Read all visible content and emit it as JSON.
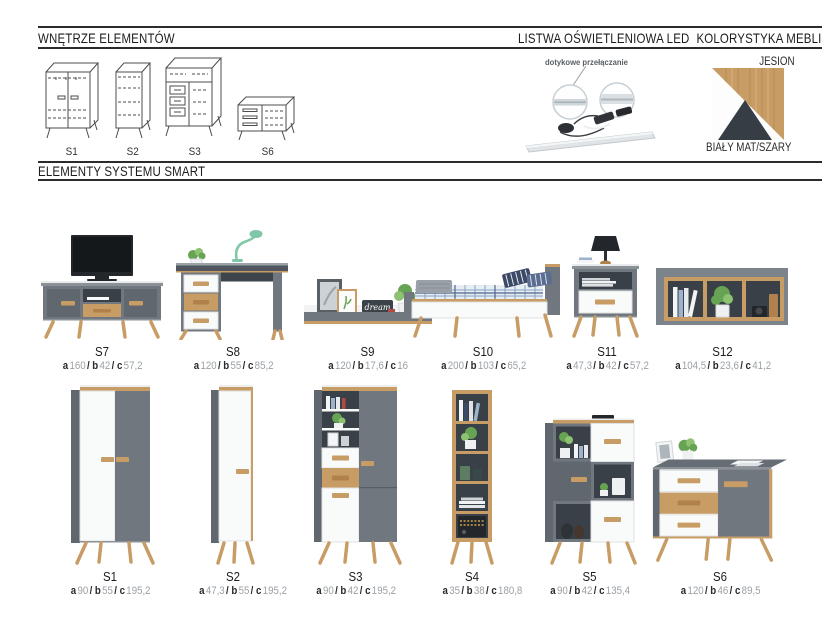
{
  "headers": {
    "interiors": "WNĘTRZE ELEMENTÓW",
    "led": "LISTWA OŚWIETLENIOWA LED",
    "colors": "KOLORYSTYKA MEBLI",
    "system": "ELEMENTY SYSTEMU SMART"
  },
  "led": {
    "caption": "dotykowe przełączanie"
  },
  "palette": {
    "label_top": "JESION",
    "label_bottom": "BIAŁY MAT/SZARY",
    "wood": "#c89c65",
    "graphite": "#363d44",
    "white": "#fdfdfd"
  },
  "interiors": [
    {
      "label": "S1"
    },
    {
      "label": "S2"
    },
    {
      "label": "S3"
    },
    {
      "label": "S6"
    }
  ],
  "dim_labels": {
    "a": "a",
    "b": "b",
    "c": "c",
    "sep": "/"
  },
  "row1": [
    {
      "name": "S7",
      "a": "160",
      "b": "42",
      "c": "57,2"
    },
    {
      "name": "S8",
      "a": "120",
      "b": "55",
      "c": "85,2"
    },
    {
      "name": "S9",
      "a": "120",
      "b": "17,6",
      "c": "16"
    },
    {
      "name": "S10",
      "a": "200",
      "b": "103",
      "c": "65,2"
    },
    {
      "name": "S11",
      "a": "47,3",
      "b": "42",
      "c": "57,2"
    },
    {
      "name": "S12",
      "a": "104,5",
      "b": "23,6",
      "c": "41,2"
    }
  ],
  "row2": [
    {
      "name": "S1",
      "a": "90",
      "b": "55",
      "c": "195,2"
    },
    {
      "name": "S2",
      "a": "47,3",
      "b": "55",
      "c": "195,2"
    },
    {
      "name": "S3",
      "a": "90",
      "b": "42",
      "c": "195,2"
    },
    {
      "name": "S4",
      "a": "35",
      "b": "38",
      "c": "180,8"
    },
    {
      "name": "S5",
      "a": "90",
      "b": "42",
      "c": "135,4"
    },
    {
      "name": "S6",
      "a": "120",
      "b": "46",
      "c": "89,5"
    }
  ],
  "decor": {
    "shelf_sign": "dream"
  }
}
